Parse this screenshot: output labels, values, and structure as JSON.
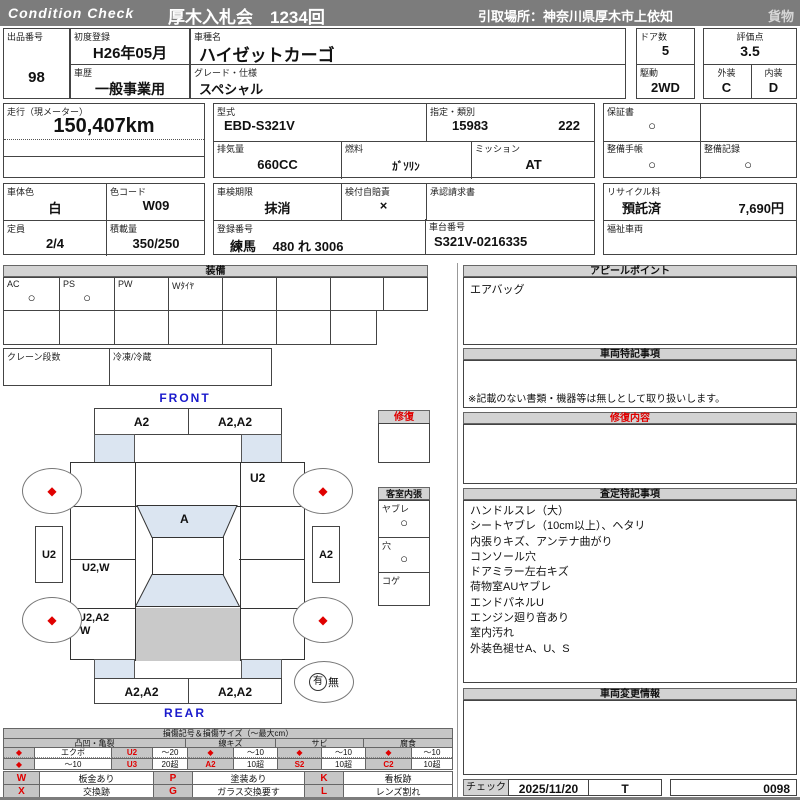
{
  "header": {
    "brand": "Condition  Check",
    "auction": "厚木入札会　1234回",
    "pickup": "引取場所：神奈川県厚木市上依知",
    "cargo": "貨物"
  },
  "info": {
    "exhibit_no_label": "出品番号",
    "exhibit_no": "98",
    "first_reg_label": "初度登録",
    "first_reg": "H26年05月",
    "history_label": "車歴",
    "history": "一般事業用",
    "model_name_label": "車種名",
    "model_name": "ハイゼットカーゴ",
    "grade_label": "グレード・仕様",
    "grade": "スペシャル",
    "doors_label": "ドア数",
    "doors": "5",
    "drive_label": "駆動",
    "drive": "2WD",
    "score_label": "評価点",
    "score": "3.5",
    "exterior_label": "外装",
    "exterior": "C",
    "interior_label": "内装",
    "interior": "D",
    "odo_label": "走行（現メーター）",
    "odo": "150,407km",
    "model_code_label": "型式",
    "model_code": "EBD-S321V",
    "class_label": "指定・類別",
    "class_no1": "15983",
    "class_no2": "222",
    "displacement_label": "排気量",
    "displacement": "660CC",
    "fuel_label": "燃料",
    "fuel": "ｶﾞｿﾘﾝ",
    "transmission_label": "ミッション",
    "transmission": "AT",
    "warranty_label": "保証書",
    "warranty": "○",
    "maintenance_book_label": "整備手帳",
    "maintenance_book": "○",
    "maintenance_record_label": "整備記録",
    "maintenance_record": "○",
    "body_color_label": "車体色",
    "body_color": "白",
    "color_code_label": "色コード",
    "color_code": "W09",
    "capacity_label": "定員",
    "capacity": "2/4",
    "load_label": "積載量",
    "load": "350/250",
    "inspection_label": "車検期限",
    "inspection": "抹消",
    "insurance_label": "検付自賠責",
    "insurance": "×",
    "approval_label": "承認請求書",
    "reg_no_label": "登録番号",
    "reg_no": "練馬　 480 れ 3006",
    "chassis_label": "車台番号",
    "chassis": "S321V-0216335",
    "recycle_label": "リサイクル料",
    "recycle_status": "預託済",
    "recycle_fee": "7,690円",
    "welfare_label": "福祉車両"
  },
  "equipment": {
    "title": "装備",
    "cells": [
      {
        "label": "AC",
        "value": "○"
      },
      {
        "label": "PS",
        "value": "○"
      },
      {
        "label": "PW",
        "value": ""
      },
      {
        "label": "Wﾀｲﾔ",
        "value": ""
      }
    ],
    "crane_label": "クレーン段数",
    "fridge_label": "冷凍/冷蔵"
  },
  "cabin": {
    "repair_title": "修復",
    "title": "客室内張",
    "items": [
      {
        "label": "ヤブレ",
        "value": "○"
      },
      {
        "label": "穴",
        "value": "○"
      },
      {
        "label": "コゲ",
        "value": ""
      }
    ]
  },
  "diagram": {
    "front_label": "FRONT",
    "rear_label": "REAR",
    "front_bumper_left": "A2",
    "front_bumper_right": "A2,A2",
    "hood_right": "U2",
    "windshield": "A",
    "left_outer": "U2",
    "right_outer": "A2",
    "left_mid": "U2,W",
    "left_rear_line1": "U2,A2",
    "left_rear_line2": "W",
    "rear_bumper_left": "A2,A2",
    "rear_bumper_right": "A2,A2",
    "wheel_mark": "◆",
    "presence_yes": "有",
    "presence_no": "無"
  },
  "sections": {
    "appeal": {
      "title": "アピールポイント",
      "content": "エアバッグ"
    },
    "vehicle_notes": {
      "title": "車両特記事項",
      "note": "※記載のない書類・機器等は無しとして取り扱いします。"
    },
    "repair_details": {
      "title": "修復内容"
    },
    "assessment": {
      "title": "査定特記事項",
      "lines": [
        "ハンドルスレ（大）",
        "シートヤブレ（10cm以上）、ヘタリ",
        "内張りキズ、アンテナ曲がり",
        "コンソール穴",
        "ドアミラー左右キズ",
        "荷物室AUヤブレ",
        "エンドパネルU",
        "エンジン廻り音あり",
        "室内汚れ",
        "外装色褪せA、U、S"
      ]
    },
    "changes": {
      "title": "車両変更情報"
    }
  },
  "footer": {
    "check_label": "チェック",
    "check_date": "2025/11/20",
    "checker": "T",
    "serial": "0098"
  },
  "legend": {
    "title": "損傷記号＆損傷サイズ（～最大cm）",
    "groups": [
      "凸凹・亀裂",
      "線キズ",
      "サビ",
      "腐食"
    ],
    "row1": [
      "◆",
      "エクボ",
      "U2",
      "～20",
      "◆",
      "～10",
      "◆",
      "～10",
      "◆",
      "～10"
    ],
    "row2": [
      "◆",
      "～10",
      "U3",
      "20超",
      "A2",
      "10超",
      "S2",
      "10超",
      "C2",
      "10超"
    ],
    "codes": [
      "W",
      "板金あり",
      "P",
      "塗装あり",
      "K",
      "看板跡",
      "X",
      "交換跡",
      "G",
      "ガラス交換要す",
      "L",
      "レンズ割れ"
    ]
  },
  "colors": {
    "accent_red": "#e00000",
    "label_blue": "#1a1acc",
    "panel_blue": "#dbe5f1",
    "roof_gray": "#c9c9c9",
    "bar_gray": "#7c7c7c"
  }
}
